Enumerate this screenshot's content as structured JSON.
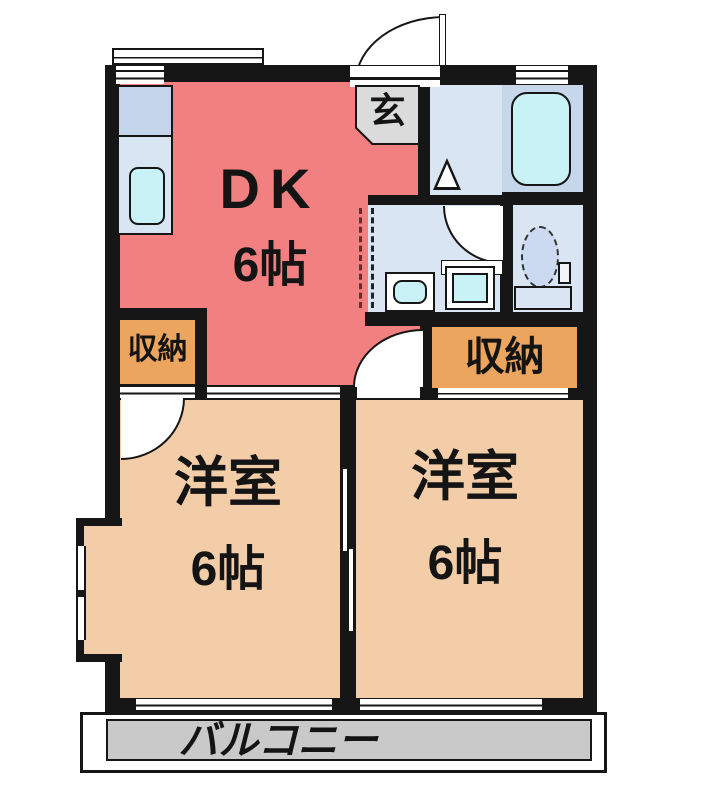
{
  "palette": {
    "wall": "#161616",
    "dk_fill": "#F28080",
    "bedroom_fill": "#F2CDA8",
    "storage_fill": "#ECA55F",
    "balcony_fill": "#C9C9C9",
    "entrance_fill": "#DBDBDB",
    "wet_room_fill": "#D9E5F3",
    "bath_room_fill": "#C6D7EC",
    "fixture_water_fill": "#C9F2F6"
  },
  "rooms": {
    "dk": {
      "name": "DK",
      "size": "6帖"
    },
    "bedroom_left": {
      "name": "洋室",
      "size": "6帖"
    },
    "bedroom_right": {
      "name": "洋室",
      "size": "6帖"
    },
    "storage_left": {
      "label": "収納"
    },
    "storage_right": {
      "label": "収納"
    },
    "entrance": {
      "label": "玄"
    },
    "balcony": {
      "label": "バルコニー"
    }
  },
  "fixtures": {
    "kitchen_sink": "kitchen-sink",
    "bathtub": "bathtub",
    "toilet": "toilet",
    "washbasin": "washbasin",
    "washing_machine_pan": "washing-machine-pan",
    "entrance_door": "swing-door",
    "bedroom_doors": "swing-door",
    "partition_door": "sliding-door"
  }
}
